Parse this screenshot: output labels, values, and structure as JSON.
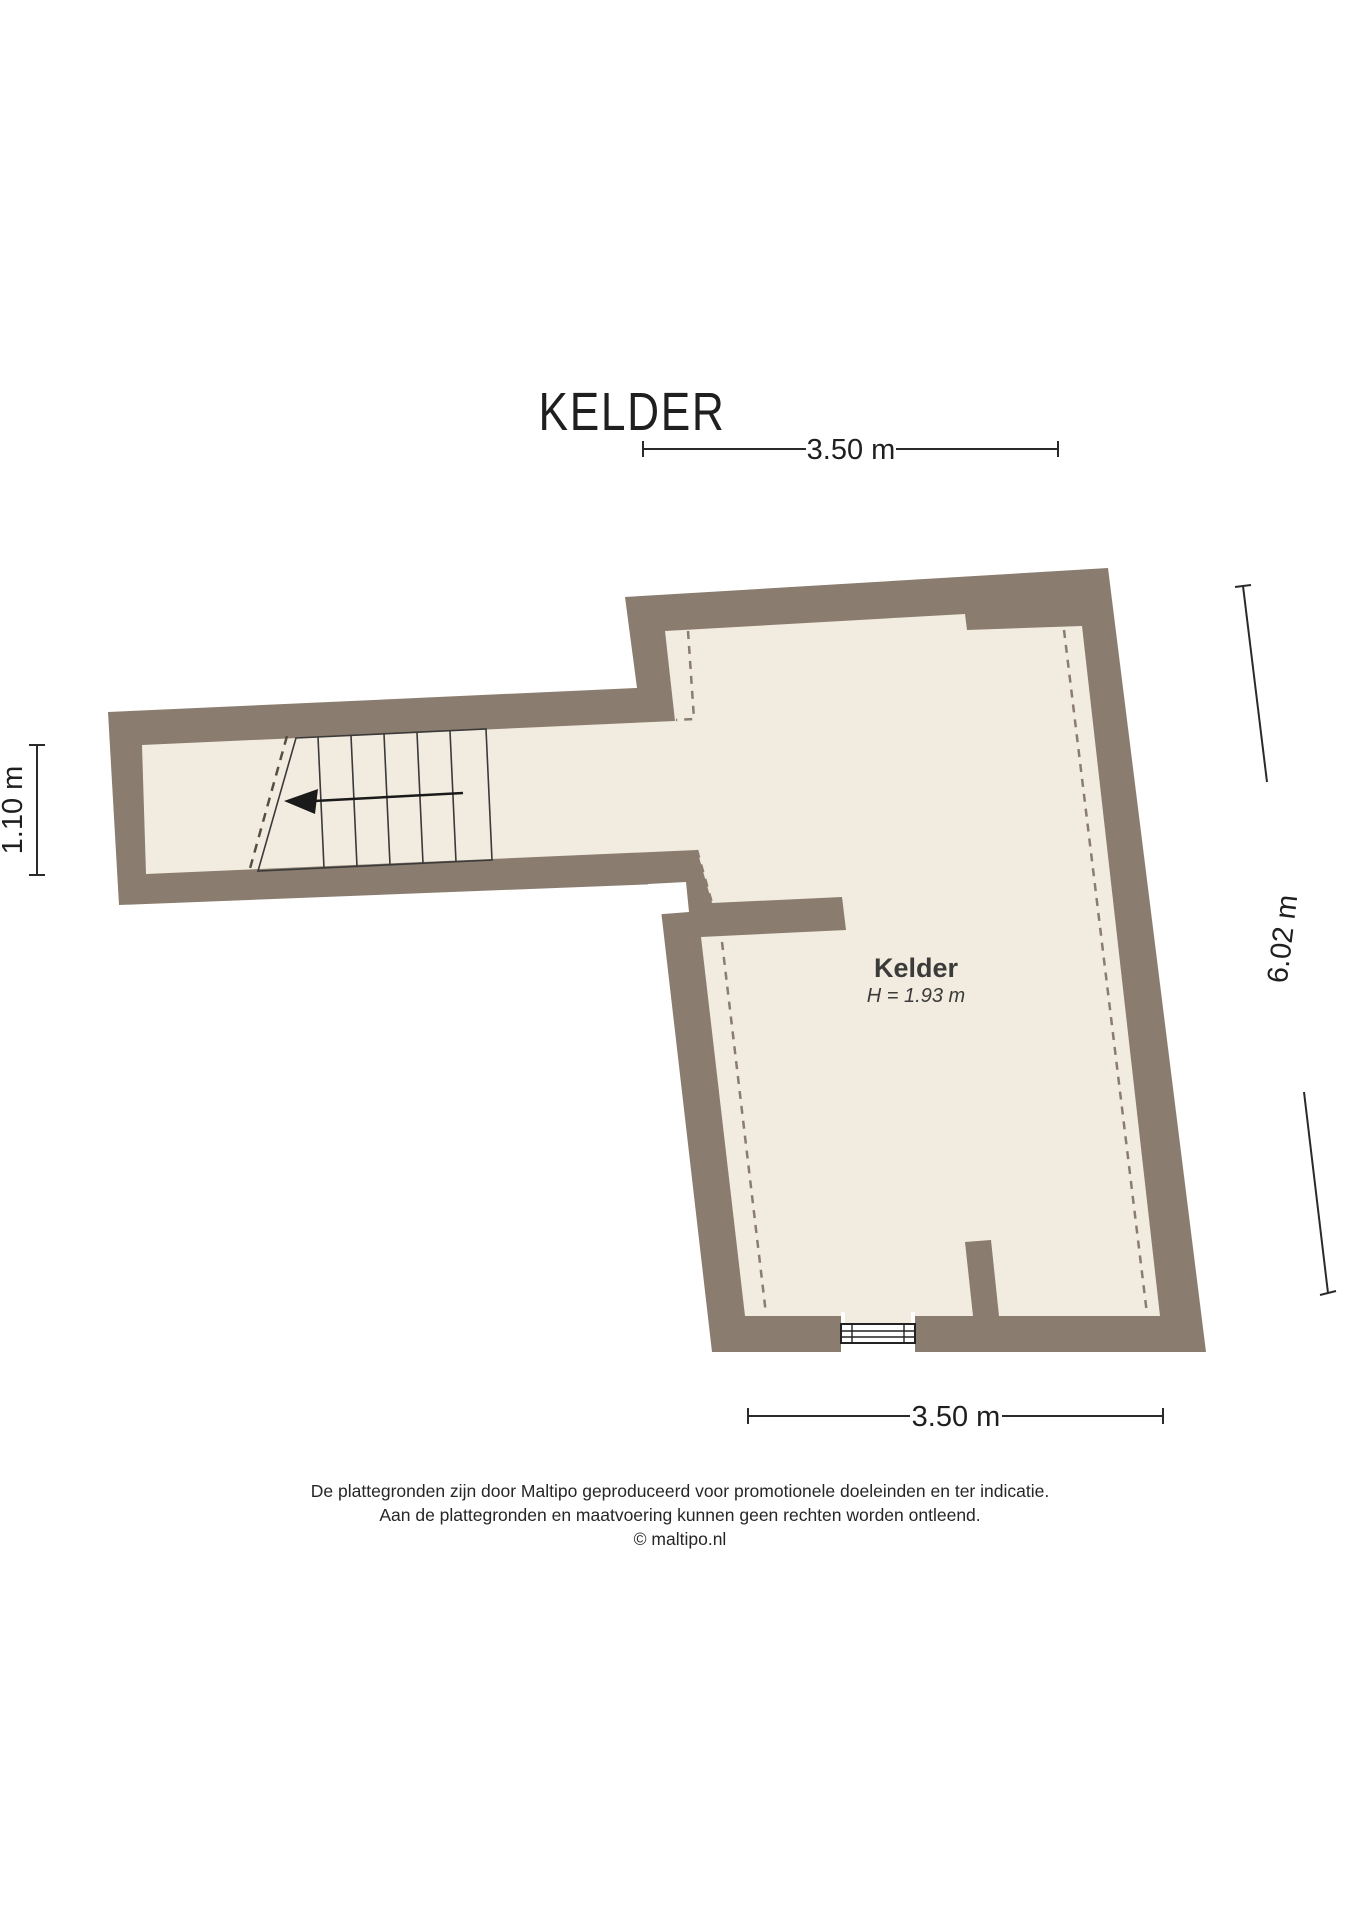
{
  "title": "KELDER",
  "room": {
    "name": "Kelder",
    "height_label": "H = 1.93 m"
  },
  "dimensions": {
    "top": "3.50 m",
    "bottom": "3.50 m",
    "right": "6.02 m",
    "left": "1.10 m"
  },
  "plan": {
    "stair_arrow_icon": "stairs-direction-arrow-left",
    "window_icon": "window-symbol"
  },
  "footer": {
    "line1": "De plattegronden zijn door Maltipo geproduceerd voor promotionele doeleinden en ter indicatie.",
    "line2": "Aan de plattegronden en maatvoering kunnen geen rechten worden ontleend.",
    "line3": "© maltipo.nl"
  },
  "colors": {
    "wall": "#8a7c6e",
    "floor": "#f2ebdf",
    "line": "#2a2a2a",
    "text": "#1f1f1f",
    "dash": "#8a7c6e"
  }
}
